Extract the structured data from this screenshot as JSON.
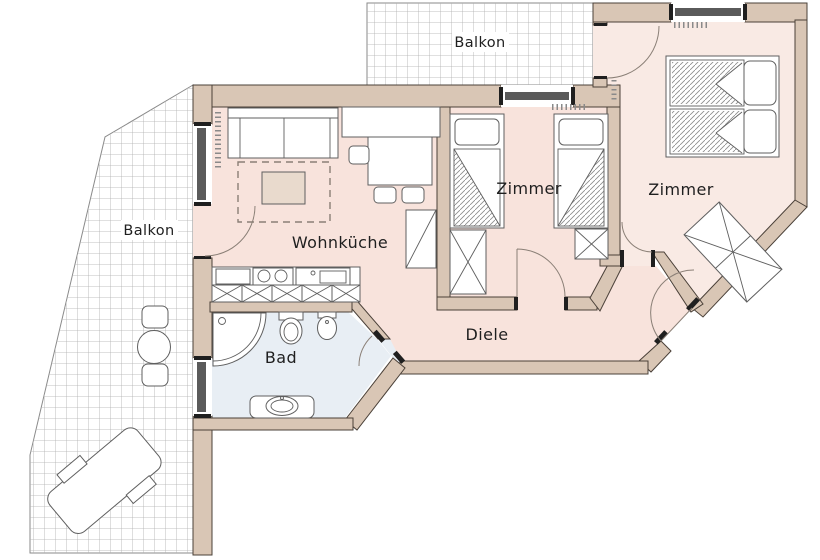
{
  "labels": {
    "balcony_top": "Balkon",
    "balcony_left": "Balkon",
    "living_kitchen": "Wohnküche",
    "bedroom_center": "Zimmer",
    "bedroom_right": "Zimmer",
    "hallway": "Diele",
    "bathroom": "Bad"
  },
  "colors": {
    "wall": "#d9c6b5",
    "wall_outline": "#4a4038",
    "floor_main": "#f8e3dc",
    "floor_bedroom_right": "#f9eae4",
    "floor_bathroom": "#e8eef4",
    "balcony_grid_line": "#adadad",
    "window_glazing": "#5a5a5a",
    "furniture_outline": "#5f5f5f",
    "label_text": "#1f1f1f"
  }
}
